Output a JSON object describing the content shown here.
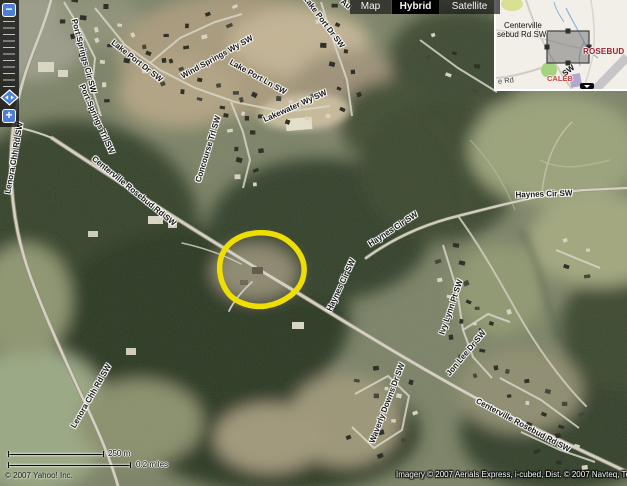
{
  "map_type_tabs": {
    "map": "Map",
    "hybrid": "Hybrid",
    "satellite": "Satellite",
    "active": "Hybrid"
  },
  "controls": {
    "zoom_out": "−",
    "zoom_in": "+"
  },
  "road_labels": [
    {
      "id": "port-springs-cir",
      "text": "Port Springs Cir SW"
    },
    {
      "id": "lake-port-dr-1",
      "text": "Lake Port Dr SW"
    },
    {
      "id": "wind-springs-wy",
      "text": "Wind Springs Wy SW"
    },
    {
      "id": "lake-port-ln",
      "text": "Lake Port Ln SW"
    },
    {
      "id": "lake-port-dr-2",
      "text": "Lake Port Dr SW"
    },
    {
      "id": "lakewater-wy",
      "text": "Lakewater Wy SW"
    },
    {
      "id": "au-partial",
      "text": "Au"
    },
    {
      "id": "port-springs-trl",
      "text": "Port Springs Trl SW"
    },
    {
      "id": "lenora-chh-1",
      "text": "Lenora Chh Rd SW"
    },
    {
      "id": "centerville-rosebud-1",
      "text": "Centerville Rosebud Rd SW"
    },
    {
      "id": "concourse-trl",
      "text": "Concourse Trl SW"
    },
    {
      "id": "haynes-cir-mid",
      "text": "Haynes Cir SW"
    },
    {
      "id": "haynes-cir-h",
      "text": "Haynes Cir SW"
    },
    {
      "id": "haynes-cir-v",
      "text": "Haynes Cir SW"
    },
    {
      "id": "ivy-lynn-pt",
      "text": "Ivy Lynn Pt SW"
    },
    {
      "id": "jon-lee-dr",
      "text": "Jon Lee Dr SW"
    },
    {
      "id": "waverly-downs",
      "text": "Waverly Downs Dr SW"
    },
    {
      "id": "lenora-chh-2",
      "text": "Lenora Chh Rd SW"
    },
    {
      "id": "centerville-rosebud-2",
      "text": "Centerville Rosebud Rd SW"
    }
  ],
  "overview": {
    "centerville_l1": "Centerville",
    "centerville_l2": "sebud Rd SW",
    "rosebud": "ROSEBUD",
    "caleb": "CALEB",
    "sw": "SW",
    "e_rd": "e Rd",
    "place_color": "#9b2033",
    "caleb_color": "#c24646"
  },
  "scale": {
    "metric": "250 m",
    "imperial": "0.2 miles"
  },
  "copyright_left": "© 2007 Yahoo! Inc.",
  "attribution_right": "Imagery © 2007 Aerials Express, i-cubed, Dist. © 2007 Navteq, Tele",
  "annotation": {
    "shape": "hand-drawn circle",
    "color": "#eedf00"
  }
}
